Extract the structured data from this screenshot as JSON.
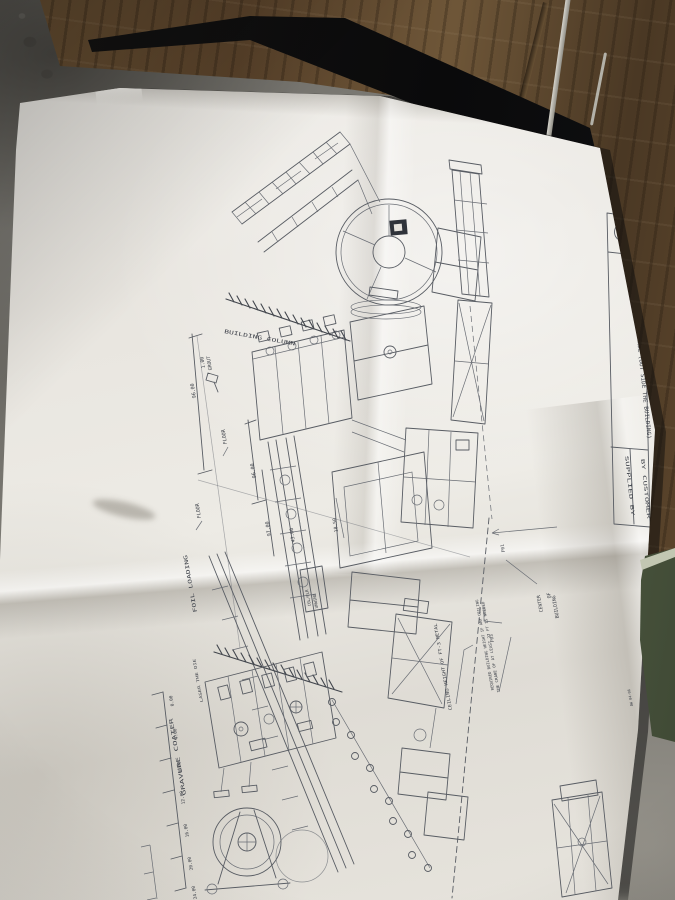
{
  "photo": {
    "subject": "folded engineering print lying on concrete floor beside wooden boards",
    "palette": {
      "concrete": "#7a7872",
      "wood": "#6b5234",
      "gap_shadow": "#0a0a0b",
      "paper": "#eae7e1",
      "ink": "#42464d",
      "green_metal": "#657250"
    }
  },
  "title_block": {
    "logo": "circle-monogram",
    "title": "(00 400) 50 CHILLER PANEL (OUT SIDE THE BUILDING)",
    "supplied_by": "SUPPLIED BY",
    "by_customer": "BY CUSTOMER"
  },
  "elevation": {
    "building_column": "BUILDING COLUMN",
    "grout_val": "1.00",
    "grout_word": "GROUT",
    "dim_96_left": "96.00",
    "floor_upper": "FLOOR",
    "dim_96_mid": "96.00",
    "floor_lower": "FLOOR",
    "dim_97": "97.00",
    "dim_43": "43.00",
    "dim_1850": "18.50",
    "unwind_line1": "COL/FLR",
    "unwind_line2": "UNWIND"
  },
  "plan": {
    "foil_loading": "FOIL LOADING",
    "laser_die": "LASER THE DIE",
    "gravure_coater": "GRAVURE COATER",
    "center_line1": "CENTER",
    "center_line2": "OF",
    "center_line3": "BUILDING",
    "ceiling_height": "CEILING HEIGHT OF FT-3 METAL",
    "note_line1": "REQUIRED BUILDING HEIGHT IF ANY CEILING",
    "note_line2": "THE CRANE OF AT LEAST 27 FT IS NEEDED",
    "tag_f01": "F01",
    "tag_f03": "F03",
    "edge_mark": "AW 04-06",
    "scale_ticks": [
      "0.00",
      "4.00",
      "8.00",
      "12.00",
      "16.00",
      "20.00",
      "24.00"
    ]
  }
}
